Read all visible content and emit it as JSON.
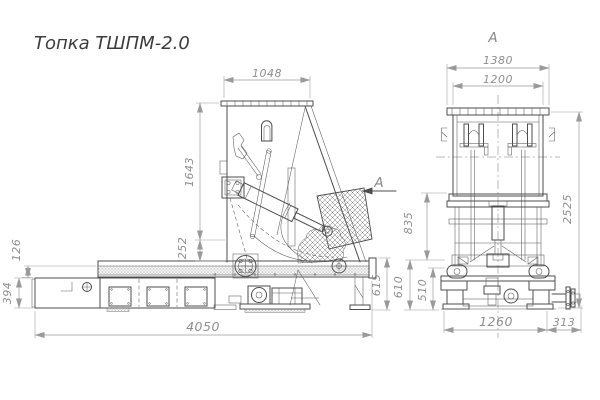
{
  "title": "Топка ТШПМ-2.0",
  "colors": {
    "line": "#4d4d4d",
    "dimension_text": "#8f8f8f",
    "background": "#ffffff"
  },
  "side_view": {
    "view_arrow_label": "A",
    "dimensions": {
      "hopper_top_width": "1048",
      "furnace_height": "1643",
      "pivot_offset": "252",
      "chain_rise": "126",
      "trough_height": "394",
      "overall_length": "4050",
      "rear_frame_height": "615"
    }
  },
  "front_view": {
    "view_label": "A",
    "dimensions": {
      "flange_width": "1380",
      "body_width": "1200",
      "overall_height": "2525",
      "frame_height": "835",
      "base_height": "610",
      "foot_height": "510",
      "base_width": "1260",
      "shaft_overhang": "313"
    }
  }
}
